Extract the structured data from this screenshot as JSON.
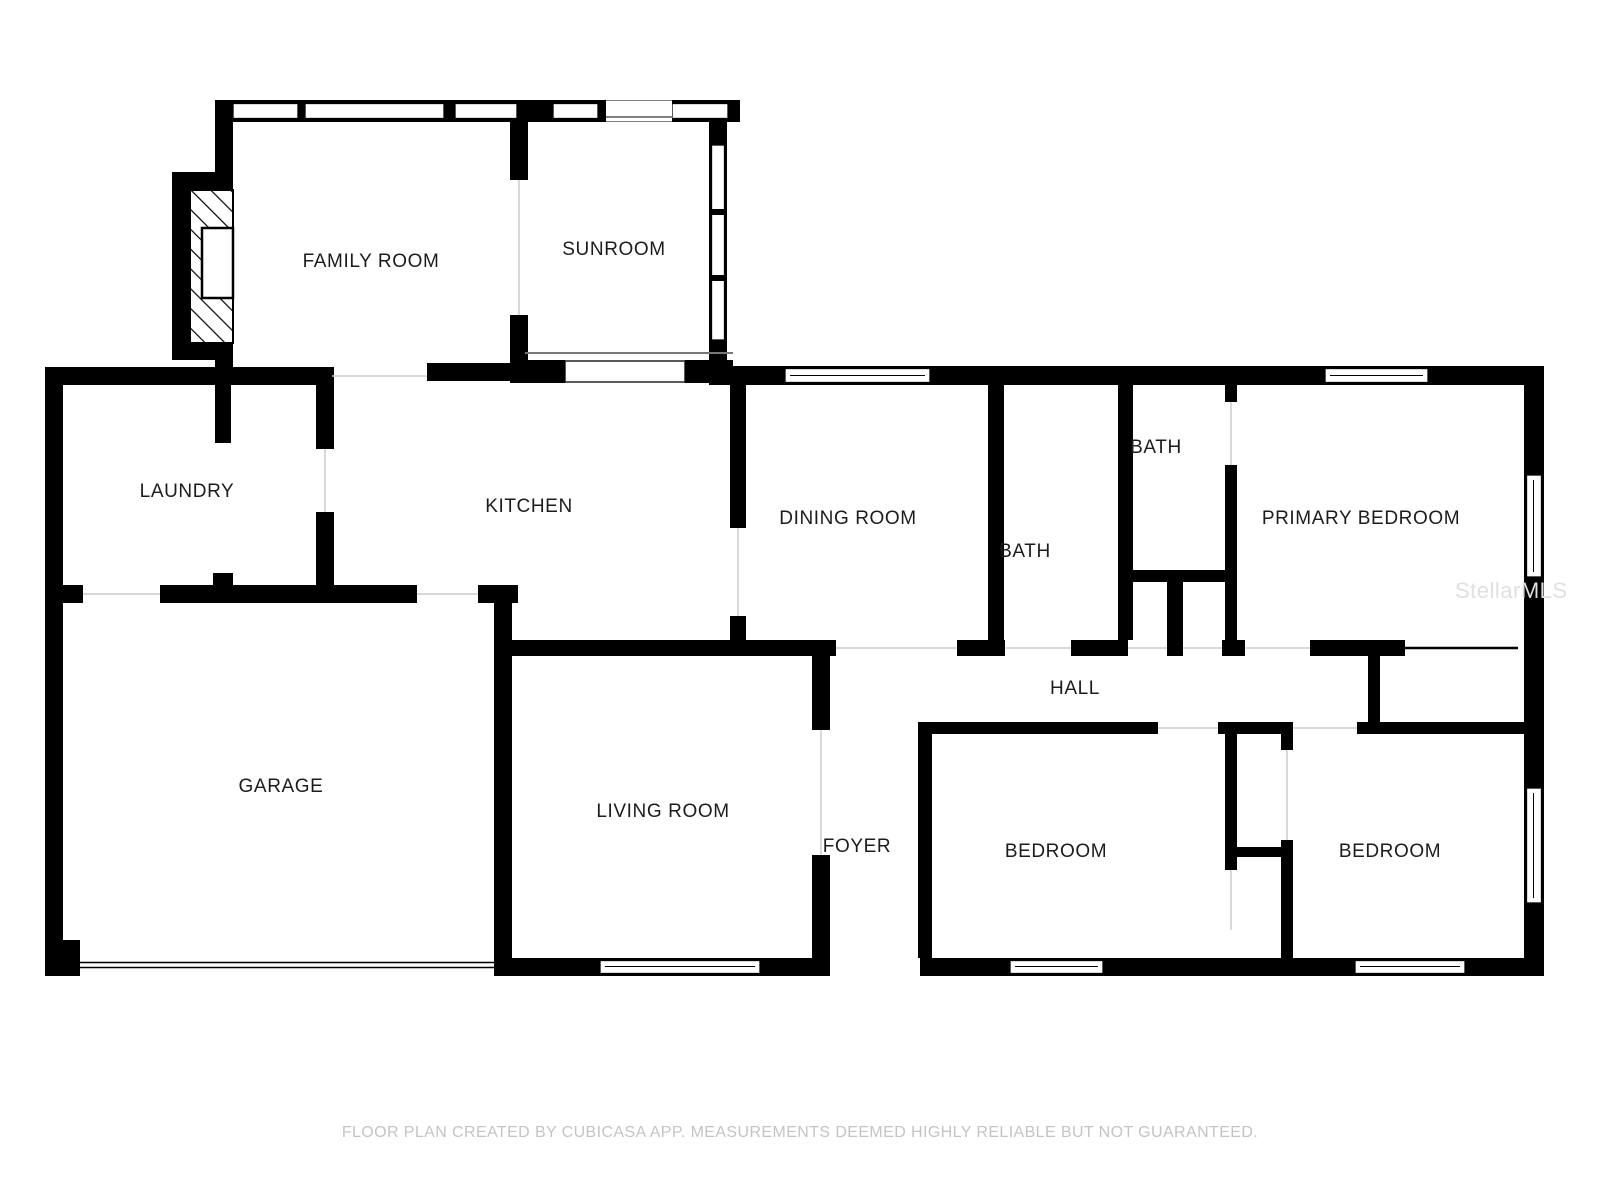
{
  "document": {
    "type": "floor-plan",
    "creator_note": "FLOOR PLAN CREATED BY CUBICASA APP. MEASUREMENTS DEEMED HIGHLY RELIABLE BUT NOT GUARANTEED."
  },
  "rooms": [
    {
      "label": "FAMILY ROOM"
    },
    {
      "label": "SUNROOM"
    },
    {
      "label": "LAUNDRY"
    },
    {
      "label": "KITCHEN"
    },
    {
      "label": "DINING ROOM"
    },
    {
      "label": "BATH"
    },
    {
      "label": "BATH"
    },
    {
      "label": "PRIMARY BEDROOM"
    },
    {
      "label": "GARAGE"
    },
    {
      "label": "LIVING ROOM"
    },
    {
      "label": "FOYER"
    },
    {
      "label": "HALL"
    },
    {
      "label": "BEDROOM"
    },
    {
      "label": "BEDROOM"
    }
  ],
  "footer": {
    "disclaimer": "FLOOR PLAN CREATED BY CUBICASA APP. MEASUREMENTS DEEMED HIGHLY RELIABLE BUT NOT GUARANTEED."
  },
  "watermark": {
    "text": "StellarMLS"
  },
  "colors": {
    "wall": "#000000",
    "background": "#ffffff",
    "footer_text": "#c4c4c4",
    "watermark_text": "#e0e0e0",
    "seam_line": "#cccccc"
  }
}
